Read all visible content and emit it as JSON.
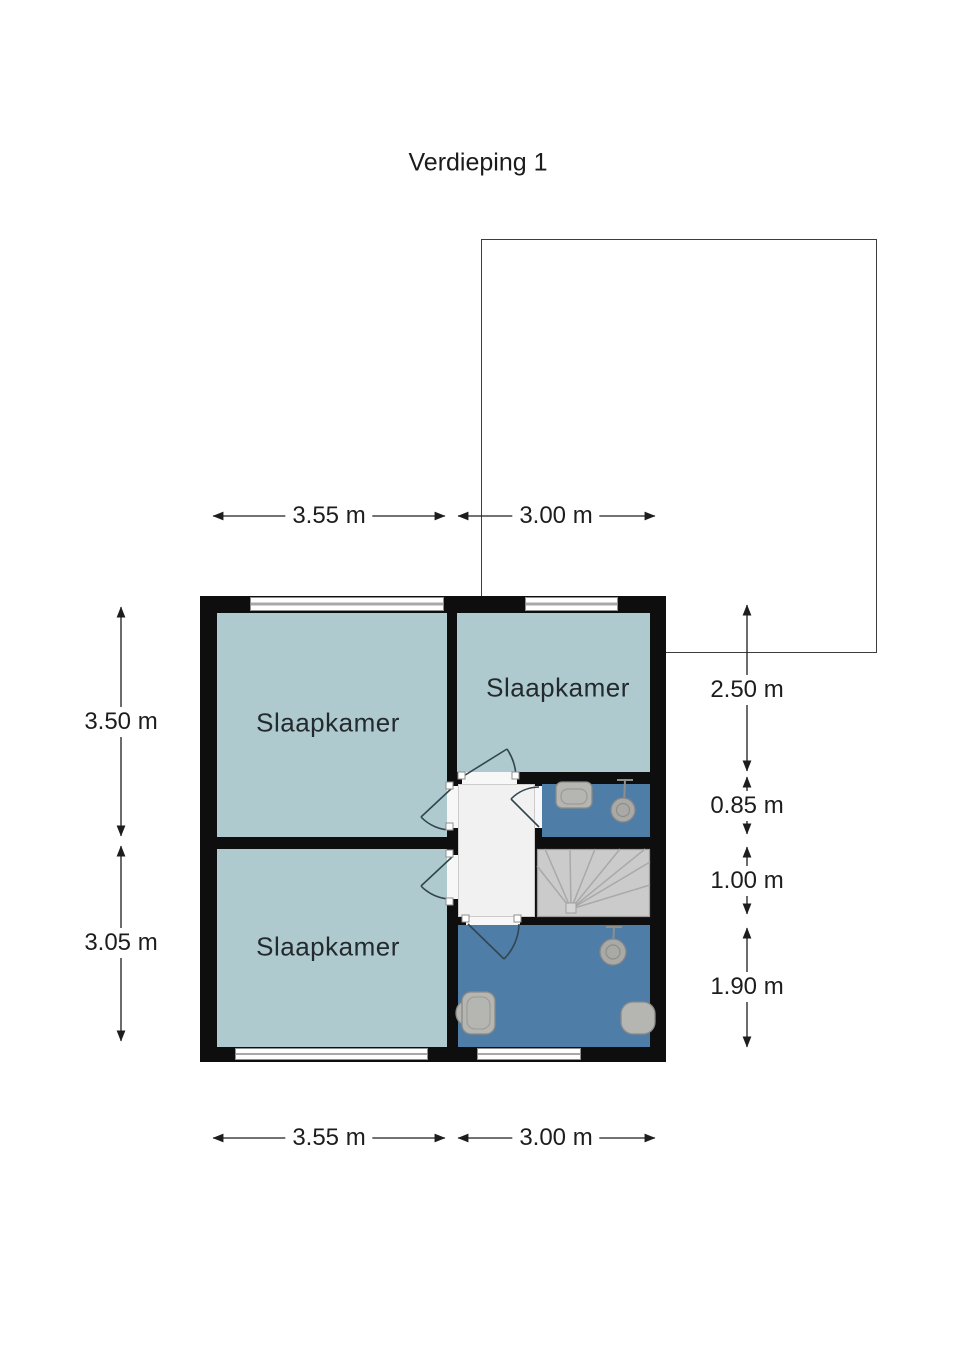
{
  "title": "Verdieping 1",
  "floor_plan": {
    "floor_label": "Verdieping 1",
    "rooms": [
      {
        "id": "bedroom-top-left",
        "label": "Slaapkamer"
      },
      {
        "id": "bedroom-top-right",
        "label": "Slaapkamer"
      },
      {
        "id": "bedroom-bottom-left",
        "label": "Slaapkamer"
      }
    ],
    "features": [
      "stairs",
      "landing",
      "shower-room",
      "bathroom",
      "roof-outline"
    ],
    "fixture_icons": [
      "sink-icon",
      "shower-head-icon",
      "toilet-icon",
      "bathtub-icon"
    ]
  },
  "dimensions": {
    "top": [
      "3.55 m",
      "3.00 m"
    ],
    "bottom": [
      "3.55 m",
      "3.00 m"
    ],
    "left": [
      "3.50 m",
      "3.05 m"
    ],
    "right": [
      "2.50 m",
      "0.85 m",
      "1.00 m",
      "1.90 m"
    ]
  },
  "colors": {
    "room_fill": "#afcace",
    "wet_room_fill": "#4e7da8",
    "wall": "#0e0e0e",
    "hall_fill": "#f1f1f1",
    "stairs_fill": "#cbcbcb",
    "fixture_fill": "#b5b5b1",
    "dimension_text": "#1d1d1d"
  }
}
